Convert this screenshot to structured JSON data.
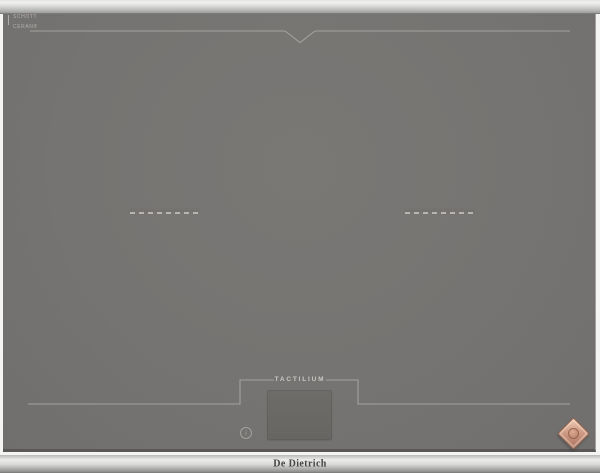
{
  "product": {
    "brand": "De Dietrich",
    "panel_label": "TACTILIUM",
    "glass_print": {
      "line1": "SCHOTT",
      "line2": "CERAN®"
    },
    "info_glyph": "i"
  },
  "markers": {
    "zone_dash_count": 7,
    "zones": [
      "left-horizontal-zone",
      "right-horizontal-zone"
    ]
  },
  "colors": {
    "glass": "#767472",
    "steel_trim": "#e0e0de",
    "marking_line": "#a9a7a3",
    "logo_copper": "#c7947c",
    "display": "#6b6966",
    "wordmark_text": "#454545"
  }
}
